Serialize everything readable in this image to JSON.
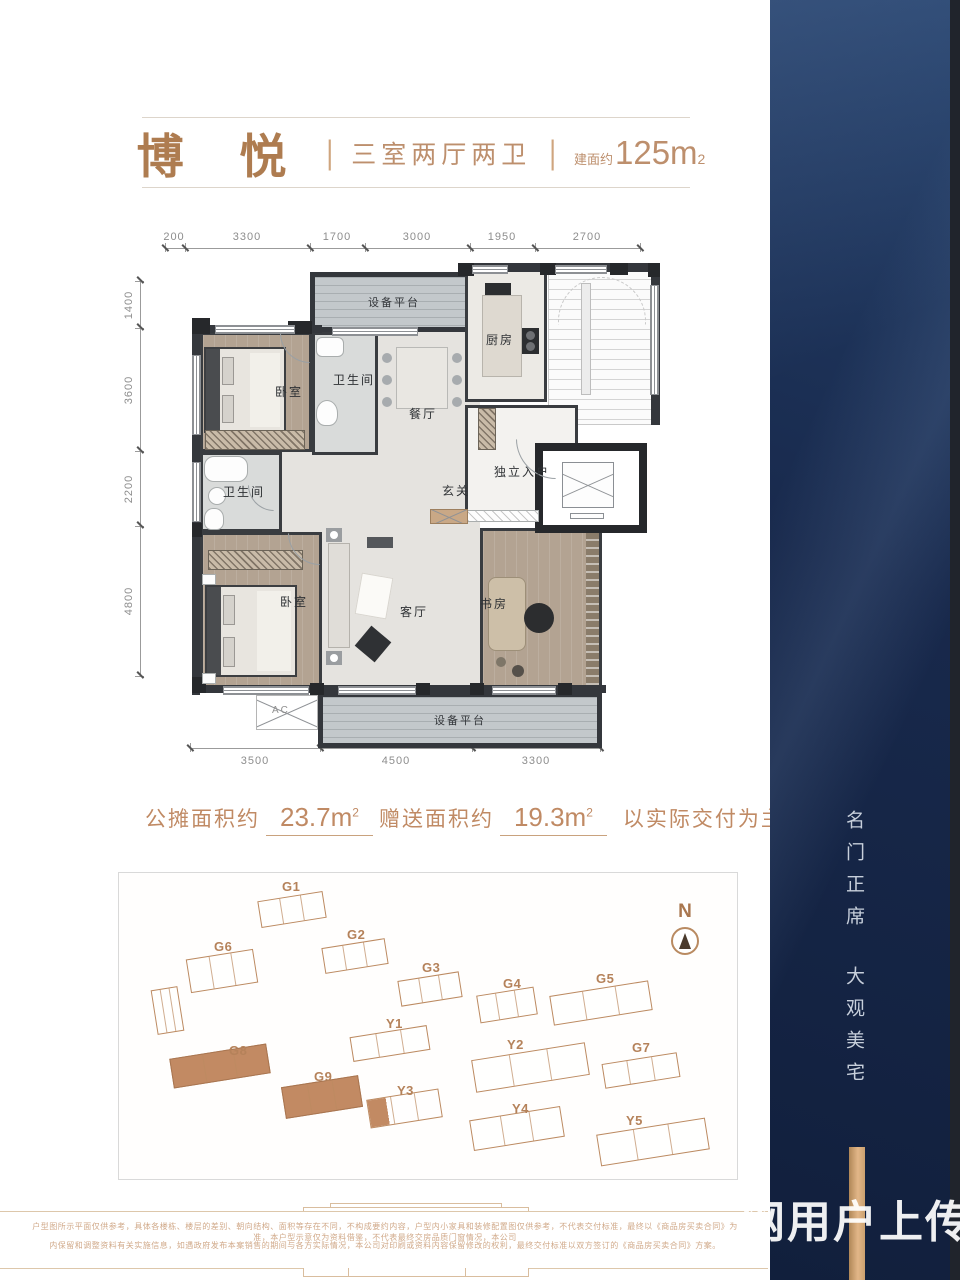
{
  "header": {
    "name": "博 悦",
    "divider": "|",
    "layout": "三室两厅两卫",
    "area_prefix": "建面约",
    "area_value": "125m",
    "area_sup": "2"
  },
  "floor_plan": {
    "dims_top": [
      "200",
      "3300",
      "1700",
      "3000",
      "1950",
      "2700"
    ],
    "dims_left": [
      "1400",
      "3600",
      "2200",
      "4800"
    ],
    "dims_bottom": [
      "3500",
      "4500",
      "3300"
    ],
    "rooms": {
      "equip_top": "设备平台",
      "kitchen": "厨房",
      "bedroom_top": "卧室",
      "bath_top": "卫生间",
      "dining": "餐厅",
      "entry": "独立入户",
      "foyer": "玄关",
      "bath_left": "卫生间",
      "bedroom_bottom": "卧室",
      "living": "客厅",
      "study": "书房",
      "equip_bottom": "设备平台",
      "ac": "AC"
    }
  },
  "area_info": {
    "share_label": "公摊面积约",
    "share_value": "23.7m",
    "share_sup": "2",
    "gift_label": "赠送面积约",
    "gift_value": "19.3m",
    "gift_sup": "2",
    "note": "以实际交付为主"
  },
  "site_plan": {
    "north_label": "N",
    "buildings": [
      {
        "label": "G1",
        "x": 140,
        "y": 23,
        "w": 66,
        "h": 27,
        "rot": -9,
        "lx": 163,
        "ly": 6,
        "fill": "none"
      },
      {
        "label": "G2",
        "x": 204,
        "y": 70,
        "w": 64,
        "h": 26,
        "rot": -9,
        "lx": 228,
        "ly": 54,
        "fill": "none"
      },
      {
        "label": "G3",
        "x": 280,
        "y": 103,
        "w": 62,
        "h": 26,
        "rot": -9,
        "lx": 303,
        "ly": 87,
        "fill": "none"
      },
      {
        "label": "G4",
        "x": 359,
        "y": 118,
        "w": 58,
        "h": 28,
        "rot": -9,
        "lx": 384,
        "ly": 103,
        "fill": "none"
      },
      {
        "label": "G5",
        "x": 432,
        "y": 115,
        "w": 100,
        "h": 30,
        "rot": -9,
        "lx": 477,
        "ly": 98,
        "fill": "none"
      },
      {
        "label": "G6",
        "x": 69,
        "y": 81,
        "w": 68,
        "h": 34,
        "rot": -9,
        "lx": 95,
        "ly": 66,
        "fill": "none"
      },
      {
        "label": "G7",
        "x": 484,
        "y": 185,
        "w": 76,
        "h": 25,
        "rot": -9,
        "lx": 513,
        "ly": 167,
        "fill": "none"
      },
      {
        "label": "G8",
        "x": 52,
        "y": 178,
        "w": 98,
        "h": 30,
        "rot": -9,
        "lx": 110,
        "ly": 170,
        "fill": "full"
      },
      {
        "label": "G9",
        "x": 164,
        "y": 208,
        "w": 78,
        "h": 32,
        "rot": -9,
        "lx": 195,
        "ly": 196,
        "fill": "full"
      },
      {
        "label": "Y1",
        "x": 232,
        "y": 158,
        "w": 78,
        "h": 25,
        "rot": -9,
        "lx": 267,
        "ly": 143,
        "fill": "none"
      },
      {
        "label": "Y2",
        "x": 354,
        "y": 178,
        "w": 115,
        "h": 33,
        "rot": -9,
        "lx": 388,
        "ly": 164,
        "fill": "none"
      },
      {
        "label": "Y3",
        "x": 249,
        "y": 221,
        "w": 73,
        "h": 29,
        "rot": -9,
        "lx": 278,
        "ly": 210,
        "fill": "part"
      },
      {
        "label": "Y4",
        "x": 352,
        "y": 240,
        "w": 92,
        "h": 31,
        "rot": -9,
        "lx": 393,
        "ly": 228,
        "fill": "none"
      },
      {
        "label": "Y5",
        "x": 479,
        "y": 253,
        "w": 110,
        "h": 32,
        "rot": -9,
        "lx": 507,
        "ly": 240,
        "fill": "none"
      },
      {
        "label": "",
        "x": 35,
        "y": 115,
        "w": 27,
        "h": 45,
        "rot": -9,
        "lx": 0,
        "ly": 0,
        "fill": "none"
      }
    ]
  },
  "sidebar": {
    "slogan_top": "名门正席",
    "slogan_bottom": "大观美宅"
  },
  "watermark": "网用户上传",
  "disclaimer": {
    "line1": "户型图所示平面仅供参考，具体各楼栋、楼层的差别、朝向结构、面积等存在不同，不构成要约内容，户型内小家具和装修配置图仅供参考，不代表交付标准，最终以《商品房买卖合同》为准，本户型示意仅为资料借鉴，不代表最终交房品质门窗情况，本公司",
    "line2": "内保留和调整资料有关实施信息，如遇政府发布本案销售的期间与各方实际情况，本公司对印刷或资料内容保留修改的权利，最终交付标准以双方签订的《商品房买卖合同》方案。"
  }
}
